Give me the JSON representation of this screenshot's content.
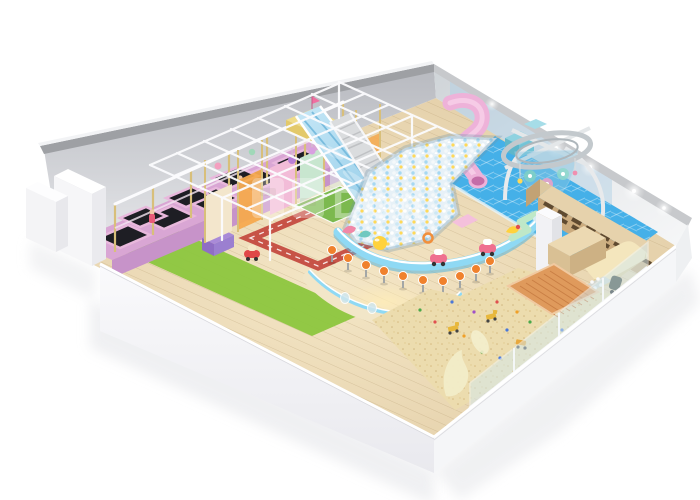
{
  "scene": {
    "watermark_text": "Don",
    "zones": [
      {
        "id": "trampoline-court",
        "label": "trampoline court"
      },
      {
        "id": "softplay-structure",
        "label": "soft play frame"
      },
      {
        "id": "wave-slide",
        "label": "blue wave slide"
      },
      {
        "id": "roller-slide",
        "label": "roller slide"
      },
      {
        "id": "spiral-tube-slide",
        "label": "pink spiral tube slide"
      },
      {
        "id": "ball-pit",
        "label": "ball pit"
      },
      {
        "id": "splash-floor",
        "label": "blue splash floor"
      },
      {
        "id": "spider-tower",
        "label": "spider tower climber"
      },
      {
        "id": "sand-pit",
        "label": "sand pit"
      },
      {
        "id": "green-mat",
        "label": "green mat walkway"
      },
      {
        "id": "toddler-area",
        "label": "toddler play area"
      },
      {
        "id": "reception",
        "label": "reception counter and cubbies"
      }
    ],
    "colors": {
      "wallCap": "#9ea0a4",
      "wallLeftFace": "#c6c8cc",
      "wallRightFace": "#dfe3e6",
      "wallWhite": "#f5f6f8",
      "floorWood": "#ead7b2",
      "greenMat": "#8cc63e",
      "waterBlue": "#45b0e8",
      "ballPitBase": "#e7f1f7",
      "poolEdge": "#8fd9f4",
      "sand": "#ecdcae",
      "deckWood": "#df9a5c",
      "cubbyWood": "#cbab7e",
      "slideBlue": "#a9d8ef",
      "slideGray": "#dadcde",
      "tubePink": "#eeb2d9",
      "trampolineDeck": "#d9a6d4",
      "trampolineBed": "#1e1e24",
      "postGold": "#d8bf7a",
      "frameWhite": "#fbfbfd",
      "stoolOrange": "#f0812c",
      "structureOrange": "#f5a94e",
      "trackRed": "#c44b40",
      "soccerGreen": "#7cb94e",
      "ottoman": "#f4e6bd",
      "watermark": "#ffffff"
    }
  }
}
